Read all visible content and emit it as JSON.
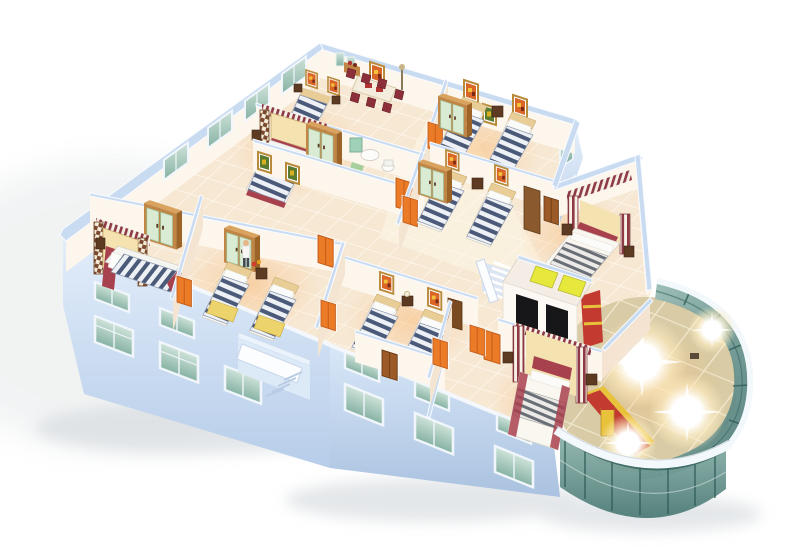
{
  "scene": {
    "type": "isometric-3d-floorplan-rendering",
    "description": "Cutaway 3D rendering of a hotel-style floor seen from above: bedrooms with striped bedding, wardrobes, orange doors, central elevator core with staircases, a dining room, bathroom, light-blue exterior facades with green windows, and a curved glass atrium with a glowing floor at the lower right.",
    "rooms": [
      {
        "id": "dining-room",
        "furniture": "long table, maroon chairs, sideboard, wall art"
      },
      {
        "id": "bedroom-arch-1",
        "furniture": "double bed with checkered arch headboard, nightstands"
      },
      {
        "id": "bathroom",
        "furniture": "sink, toilet, green mat"
      },
      {
        "id": "twin-room-1",
        "furniture": "two striped single beds, wardrobe, posters"
      },
      {
        "id": "twin-room-2",
        "furniture": "two striped single beds, wardrobe, posters"
      },
      {
        "id": "twin-room-3",
        "furniture": "two striped single beds, lamp table, posters"
      },
      {
        "id": "twin-room-4",
        "furniture": "two striped single beds with yellow blankets, wardrobe, person figure"
      },
      {
        "id": "bedroom-arch-2",
        "furniture": "double bed with checkered arch headboard, wardrobe"
      },
      {
        "id": "master-bedroom-1",
        "furniture": "canopy bed with striped columns, nightstands, tall cabinet"
      },
      {
        "id": "master-bedroom-2",
        "furniture": "canopy bed with striped columns, nightstands, closet"
      },
      {
        "id": "corridor",
        "furniture": "large cream tiles, framed pictures, orange doors"
      },
      {
        "id": "elevator-lobby",
        "furniture": "two elevators with yellow cabin tops, black door openings"
      },
      {
        "id": "stairwell",
        "furniture": "white staircase with railing, exterior stair annex"
      },
      {
        "id": "glass-atrium",
        "furniture": "curved teal glass wall, diagonal-grid floor, light flares, red and yellow reception desk"
      }
    ],
    "counts": {
      "bedrooms": 8,
      "single-beds": 8,
      "double-beds": 5,
      "wardrobes": 5,
      "elevators": 2,
      "staircases": 2,
      "light-flares": 4
    }
  },
  "colors": {
    "background": "#ffffff",
    "shadow": "#d3d8dc",
    "facade_light": "#e3eefb",
    "facade_dark": "#b7cde9",
    "wall_top": "#c9dbf1",
    "wall_face": "#fdf6ed",
    "wall_face_shade": "#f4e4d2",
    "floor_tile": "#f7e8d4",
    "floor_grout": "#fffaf0",
    "corridor_tile": "#faf0df",
    "door_orange": "#ec7b28",
    "door_orange_dark": "#c35c17",
    "door_brown": "#9c5a28",
    "window_glass_1": "#cfe3da",
    "window_glass_2": "#86b2a3",
    "window_frame": "#f0f6fb",
    "wardrobe_wood": "#c18546",
    "wardrobe_wood_dark": "#9c6426",
    "wardrobe_door_green": "#d9ebd3",
    "duvet_stripe": "#4b5a78",
    "duvet_base": "#edf0f4",
    "blanket_yellow": "#ecd36b",
    "bed_maroon": "#a8414e",
    "headboard_wood": "#e9cd96",
    "canopy_stripe": "#8e3a44",
    "canopy_panel": "#f4e2b0",
    "checker_brown": "#7b4a2e",
    "checker_cream": "#f3ead8",
    "gray_stripe": "#6a6e76",
    "art_orange": "#d96526",
    "art_green": "#5a7a30",
    "art_gold": "#b98a3a",
    "atrium_glass_light": "#9dbfb8",
    "atrium_glass_dark": "#4c7a76",
    "atrium_mullion": "#2f5b57",
    "atrium_floor": "#d8cba5",
    "atrium_grid": "#f2ead2",
    "atrium_rim": "#f3f8fc",
    "desk_red": "#c23a30",
    "desk_yellow": "#e9c23c",
    "elevator_yellow": "#e6e83c",
    "elevator_black": "#17171a",
    "stair_white": "#fcfdff",
    "flare_warm": "#fff3d2"
  }
}
